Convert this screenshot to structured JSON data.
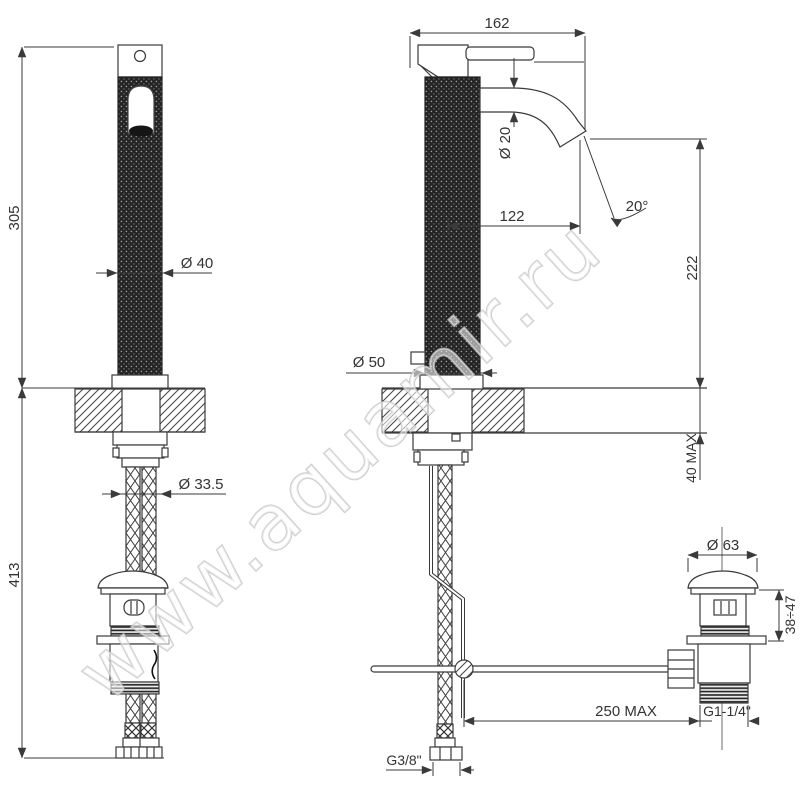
{
  "watermark": "www.aquamir.ru",
  "colors": {
    "line": "#3a3a3a",
    "text": "#333333",
    "background": "#ffffff"
  },
  "dimensions": {
    "front": {
      "height_above_deck": "305",
      "height_below_deck": "413",
      "body_diameter": "Ø 40",
      "hole_diameter": "Ø 33.5"
    },
    "side": {
      "overall_depth": "162",
      "spout_tube_diameter": "Ø 20",
      "spout_reach": "122",
      "spout_angle": "20°",
      "spout_height": "222",
      "deck_thickness_max": "40 MAX",
      "base_diameter": "Ø 50",
      "supply_thread": "G3/8\""
    },
    "drain": {
      "cap_diameter": "Ø 63",
      "adjust_range": "38÷47",
      "rod_reach_max": "250 MAX",
      "waste_thread": "G1-1/4\""
    }
  }
}
